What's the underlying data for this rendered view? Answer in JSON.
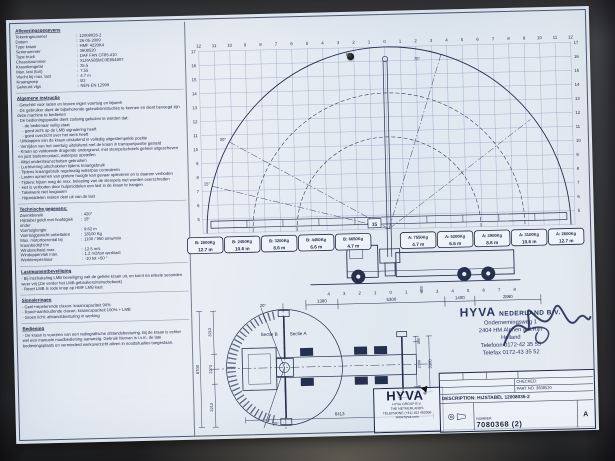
{
  "sheet": {
    "delivery": {
      "title": "Afleveringsgegevens",
      "rows": [
        {
          "l": "Tekeningnummer",
          "v": "12008026-2"
        },
        {
          "l": "Datum",
          "v": "26-05-2009"
        },
        {
          "l": "Type kraan",
          "v": "HMF 4220K4"
        },
        {
          "l": "Serienummer",
          "v": "3608520"
        },
        {
          "l": "Type truck",
          "v": "DAF FAN CF85.410"
        },
        {
          "l": "Chassisnummer",
          "v": "XLRAS85MC0E854807"
        },
        {
          "l": "Kraankengetal",
          "v": "35.5"
        },
        {
          "l": "Max. last (ton)",
          "v": "7.55"
        },
        {
          "l": "Vlucht bij max. last",
          "v": "4.7 m"
        },
        {
          "l": "Kraangroep",
          "v": "B2"
        },
        {
          "l": "Gekeurd vlgs",
          "v": "NEN-EN 12999"
        }
      ]
    },
    "instructie": {
      "title": "Algemene instructie",
      "items": [
        "- Geschikt voor laden en lossen eigen voertuig en bijwerk",
        "- De gebruiker dient de bijbehorende gebruiksinstructies te kennen en dient bevoegd zijn deze machine te bedienen",
        "- De bedieningspositie dient zodanig gekozen te worden dat:",
        "    - de bedienaar veilig staat",
        "    - goed zicht op de LMB signalering heeft",
        "    - goed overzicht over het werk heeft",
        "- Uitklappen van de kraan uitsluitend in volledig uitgestempelde positie",
        "- Verrijden van het voertuig uitsluitend met de kraan in transportpositie gesteld",
        "- Kraan op voldoende dragende ondergrond, met stempelschotels geheel uitgeschoven en juist bodemcontact, waterpas opstellen",
        "- Altijd ondersteunschotten gebruiken",
        "- Luchtvering uitschakelen tijdens kraangebruik",
        "- Tijdens kraangebruik regelmatig waterpas controleren",
        "- Lasten opnemen van grotere hoogte kan gevaar opleveren en is daarom verboden",
        "- Tijdens hijsen mag de max. belasting van de stempels niet worden overschreden",
        "- Het is verboden door hulpmiddelen een last in de kraan te hangen",
        "- Takelwerk niet losgooien",
        "- Hijsmiddelen maken deel uit van de last"
      ]
    },
    "technisch": {
      "title": "Technische gegevens:",
      "rows": [
        {
          "l": "Zwenkbereik",
          "v": "420°"
        },
        {
          "l": "Hijstabel geldt met hoofdgiek onder",
          "v": "15°"
        },
        {
          "l": "Voertuiglengte",
          "v": "9.62 m"
        },
        {
          "l": "Voertuiggewicht onbeladen",
          "v": "18100 Kg"
        },
        {
          "l": "Max. motortoerental bij kraanbedrijf t/m",
          "v": "1100 / 950 omw/min"
        },
        {
          "l": "Windsnelheid max.",
          "v": "12.5 m/s"
        },
        {
          "l": "Windoppervlak max.",
          "v": "1.2 m2/ton werklast"
        },
        {
          "l": "Werktemperatuur",
          "v": "-10 tot +50 °"
        }
      ]
    },
    "lastmoment": {
      "title": "Lastmomentbeveiliging",
      "items": [
        "- Bij inschakeling LMB beveiliging valt de gehele kraan uit, en komt na enkele seconden weer vrij (Zie verder het LMB gebruikersinstructieboek)",
        "- Reset LMB is rode knop op HMF LMB kast"
      ]
    },
    "signalering": {
      "title": "Signaleringen",
      "items": [
        "- Geel+repeterende claxon: kraancapaciteit 90%",
        "- Rood+aanhoudende claxon: kraancapaciteit 100% + LMB",
        "- Groen licht: afstandsbesturing in werking"
      ]
    },
    "bediening": {
      "title": "Bediening",
      "text": "- De kraan is voorzien van een radiografische afstandsbesturing. Bij de kraan is echter wel een manuele noodbediening aanwezig. Gebruik hiervan is i.v.m. de late bedieningsplaats en verminderd werkoverzicht alleen in noodsituaties toegestaan."
    }
  },
  "diagram": {
    "top_scale": [
      "12",
      "11",
      "10",
      "9",
      "8",
      "7",
      "6",
      "5",
      "4",
      "3",
      "2",
      "1",
      "0",
      "1",
      "2",
      "3",
      "4",
      "5",
      "6",
      "7",
      "8",
      "9",
      "10",
      "11",
      "12"
    ],
    "left_scale": [
      "17",
      "16",
      "15",
      "14",
      "13",
      "12",
      "11",
      "10",
      "9",
      "8",
      "7",
      "6",
      "5"
    ],
    "right_scale": [
      "17",
      "16",
      "15",
      "14",
      "13",
      "12",
      "11",
      "10",
      "9",
      "8",
      "7",
      "6",
      "5"
    ],
    "bottom_scale": [
      "4",
      "3",
      "2",
      "1",
      "0",
      "1",
      "2",
      "3",
      "4",
      "5",
      "6",
      "7",
      "8"
    ],
    "angles": {
      "a80": "80°",
      "a70": "70°",
      "a30": "30°",
      "a15": "15°"
    },
    "boom_box_label": "15",
    "boxes_b": [
      {
        "load": "B: 2000Kg",
        "reach": "12.7 m"
      },
      {
        "load": "B: 2450Kg",
        "reach": "10.6 m"
      },
      {
        "load": "B: 3200Kg",
        "reach": "8.6 m"
      },
      {
        "load": "B: 4450Kg",
        "reach": "6.6 m"
      },
      {
        "load": "B: 6650Kg",
        "reach": "4.7 m"
      }
    ],
    "boxes_a": [
      {
        "load": "A: 7550Kg",
        "reach": "4.7 m"
      },
      {
        "load": "A: 5200Kg",
        "reach": "6.6 m"
      },
      {
        "load": "A: 3900Kg",
        "reach": "8.6 m"
      },
      {
        "load": "A: 3100Kg",
        "reach": "10.6 m"
      },
      {
        "load": "A: 2600Kg",
        "reach": "12.7 m"
      }
    ],
    "dims_bottom": [
      "1380",
      "5300",
      "1400",
      "2860"
    ],
    "dim_overhang": "800"
  },
  "top_view": {
    "sectie_b": "Sectie B",
    "sectie_a": "Sectie A",
    "dims_left": [
      "3213",
      "2273",
      "3213"
    ],
    "dim_left_total": "8700",
    "dims_right": [
      "300",
      "2700",
      "300"
    ],
    "dim_right_total": "3300",
    "dim_bottom": "6413",
    "angle_top": "20°",
    "angle_bottom": "20°"
  },
  "stamp": {
    "brand": "HYVA",
    "company": "NEDERLAND B.V.",
    "addr1": "Ondernemingsweg 1",
    "addr2": "2404 HM Alphen a.d.Rijn",
    "addr3": "Holland",
    "tel": "Telefoon 0172-42 35 55",
    "fax": "Telefax 0172-43 35 52"
  },
  "logo_box": {
    "brand": "HYVA",
    "reg": "®",
    "line1": "HYVA GROUP B.V.",
    "line2": "THE NETHERLANDS",
    "line3": "TELEPHONE (+31) 102 402009",
    "line4": "www.hyva.com"
  },
  "title_block": {
    "checked": "CHECKED:",
    "part_no": "PART NO. 3608520",
    "description": "DESCRIPTION: HIJSTABEL 12008036-2",
    "number_label": "NUMBER",
    "number": "7080368 (2)",
    "rev": "A"
  },
  "colors": {
    "ink": "#1c2744",
    "paper": "#e7ecf3",
    "wall": "#3f4043"
  }
}
